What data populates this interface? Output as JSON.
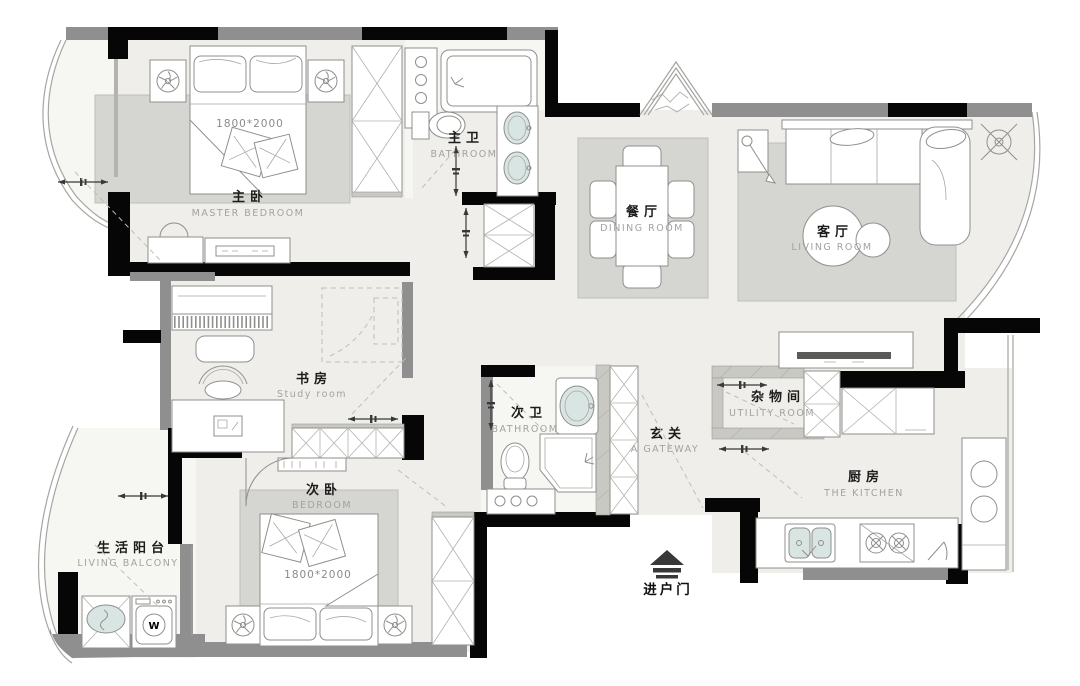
{
  "title": "三室两厅户型图 (3-bedroom apartment floor plan)",
  "colors": {
    "wall": "#060606",
    "window": "#8f8f8f",
    "floor": "#efeeea",
    "rug": "#d5d5d1",
    "bath_floor": "#f6f6f3",
    "fixture_teal": "#d9e5e3",
    "furniture_stroke": "#8f8f8c",
    "label_zh": "#1c1c1c",
    "label_en": "#a2a29e"
  },
  "rooms": [
    {
      "id": "master-bedroom",
      "label_zh": "主卧",
      "label_en": "MASTER BEDROOM"
    },
    {
      "id": "master-bathroom",
      "label_zh": "主卫",
      "label_en": "BATHROOM"
    },
    {
      "id": "dining-room",
      "label_zh": "餐厅",
      "label_en": "DINING ROOM"
    },
    {
      "id": "living-room",
      "label_zh": "客厅",
      "label_en": "LIVING ROOM"
    },
    {
      "id": "study-room",
      "label_zh": "书房",
      "label_en": "Study room"
    },
    {
      "id": "second-bathroom",
      "label_zh": "次卫",
      "label_en": "BATHROOM"
    },
    {
      "id": "gateway",
      "label_zh": "玄关",
      "label_en": "A GATEWAY"
    },
    {
      "id": "utility-room",
      "label_zh": "杂物间",
      "label_en": "UTILITY ROOM"
    },
    {
      "id": "kitchen",
      "label_zh": "厨房",
      "label_en": "THE KITCHEN"
    },
    {
      "id": "second-bedroom",
      "label_zh": "次卧",
      "label_en": "BEDROOM"
    },
    {
      "id": "living-balcony",
      "label_zh": "生活阳台",
      "label_en": "LIVING BALCONY"
    }
  ],
  "annotations": {
    "entry_door_label": "进户门",
    "master_bed_size": "1800*2000",
    "second_bed_size": "1800*2000",
    "washer_label": "W"
  },
  "icons": [
    "entry-door-arrow-icon",
    "ceiling-symbol-icon",
    "fan-swirl-icon",
    "door-slide-arrow-icon"
  ]
}
